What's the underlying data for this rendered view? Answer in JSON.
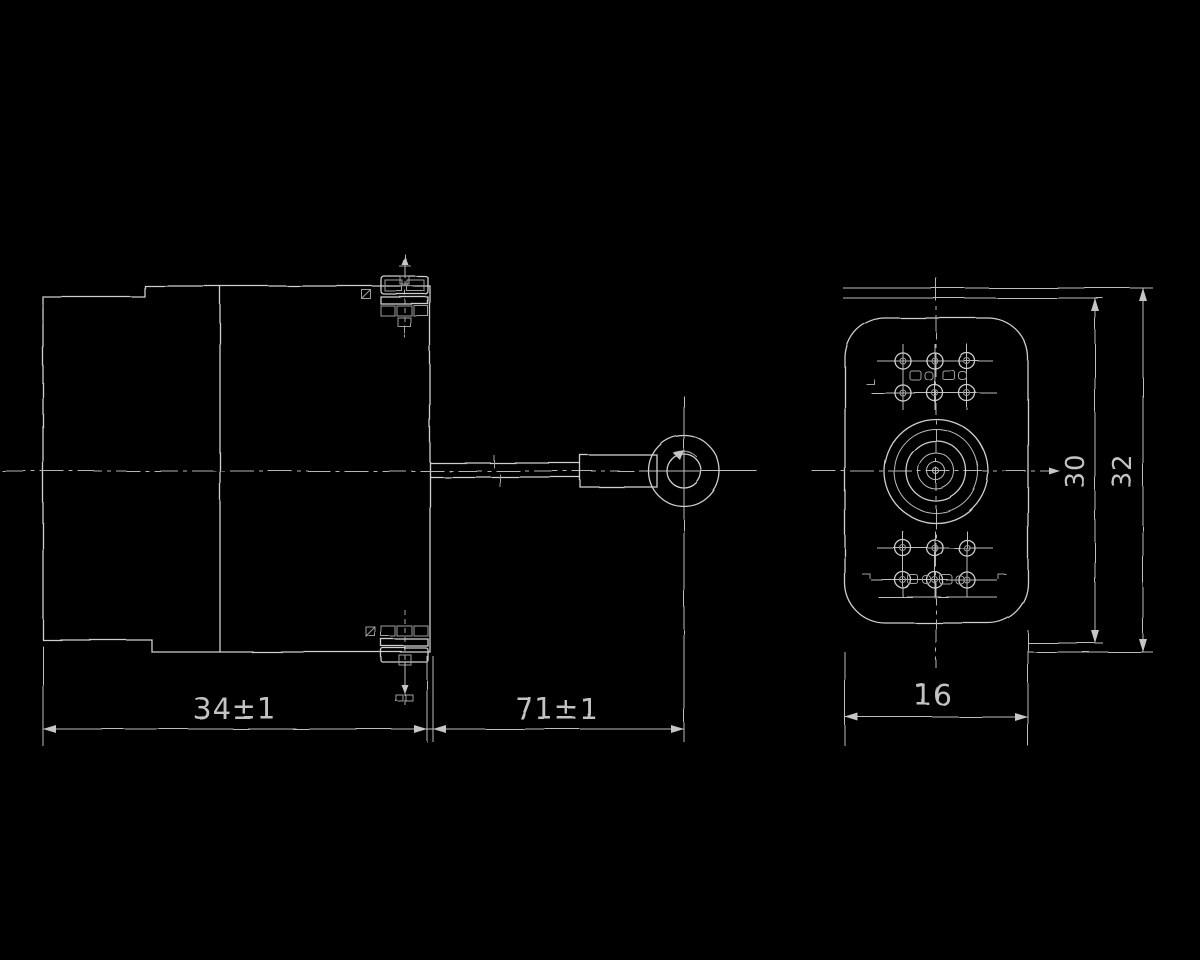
{
  "dimensions": {
    "body_length": "34±1",
    "shaft_assembly_length": "71±1",
    "front_width": "16",
    "front_height_inner": "30",
    "front_height_outer": "32"
  },
  "colors": {
    "background": "#000000",
    "line": "#cfcfcf",
    "dim_text": "#c3c3c3"
  }
}
